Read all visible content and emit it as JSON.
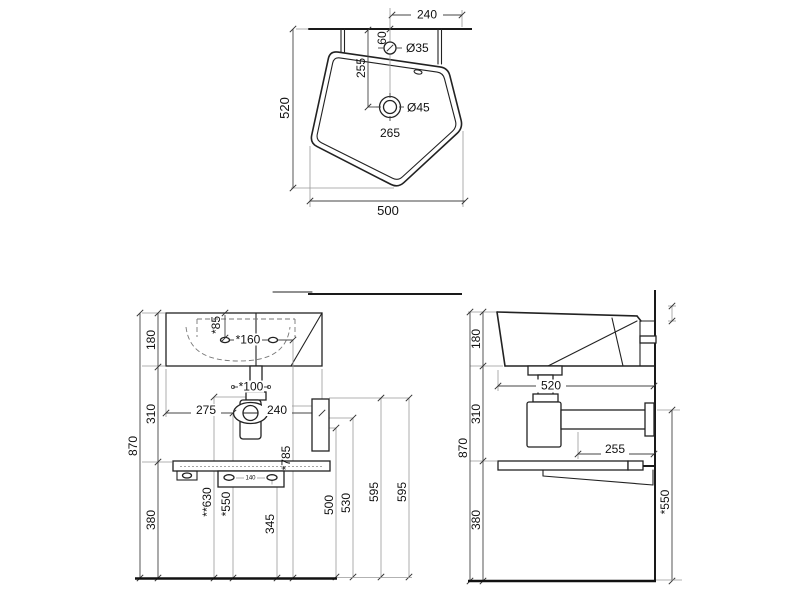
{
  "top_view": {
    "d240": "240",
    "d60": "60",
    "tap_hole": "Ø35",
    "d255": "255",
    "drain_hole": "Ø45",
    "d265": "265",
    "d520": "520",
    "d500": "500"
  },
  "front_view": {
    "d180": "180",
    "d85": "*85",
    "d160": "*160",
    "d100": "*100",
    "d275": "275",
    "d240": "240",
    "d310": "310",
    "d870": "870",
    "d380": "380",
    "d630": "**630",
    "d550": "*550",
    "d345": "345",
    "d785": "*785",
    "d140": "140",
    "d500": "500",
    "d530": "530",
    "d595a": "595",
    "d595b": "595"
  },
  "side_view": {
    "d180": "180",
    "d520": "520",
    "d310": "310",
    "d870": "870",
    "d255": "255",
    "d380": "380",
    "d550": "*550"
  },
  "colors": {
    "line": "#222222",
    "background": "#ffffff"
  }
}
